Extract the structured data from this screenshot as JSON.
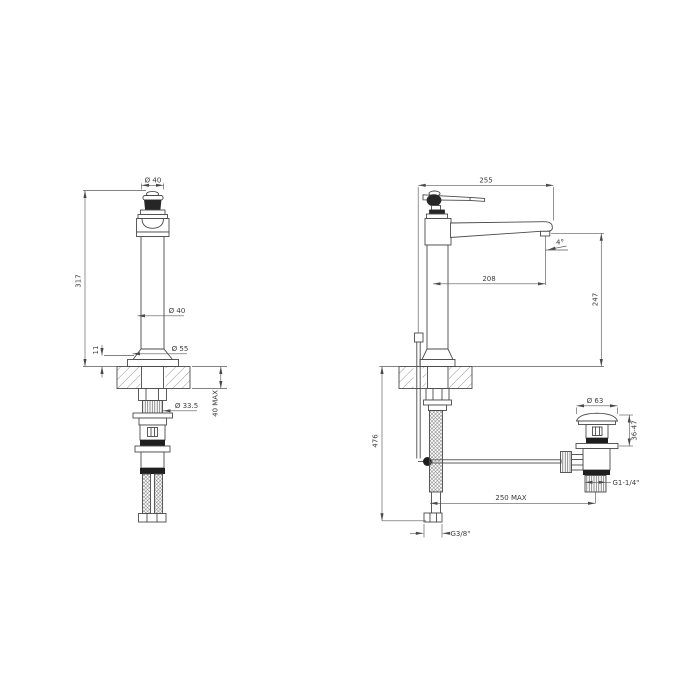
{
  "drawing": {
    "title": "tap-technical-drawing",
    "background": "#ffffff",
    "line_color": "#4a4a4a",
    "text_color": "#3a3a3a",
    "views": {
      "front": {
        "dims": {
          "handle_diameter": "Ø 40",
          "total_height": "317",
          "body_diameter": "Ø 40",
          "base_diameter": "Ø 55",
          "base_height": "11",
          "shank_diameter": "Ø 33.5",
          "deck_thickness_max": "40 MAX"
        }
      },
      "side": {
        "dims": {
          "overall_depth": "255",
          "spout_angle": "4°",
          "spout_reach": "208",
          "spout_height": "247",
          "below_deck_length": "476",
          "supply_hose_thread": "G3/8\"",
          "drain_rod_reach_max": "250 MAX"
        }
      },
      "drain": {
        "dims": {
          "plug_diameter": "Ø 63",
          "adjustment_range": "36-47",
          "waste_thread": "G1-1/4\""
        }
      }
    }
  }
}
